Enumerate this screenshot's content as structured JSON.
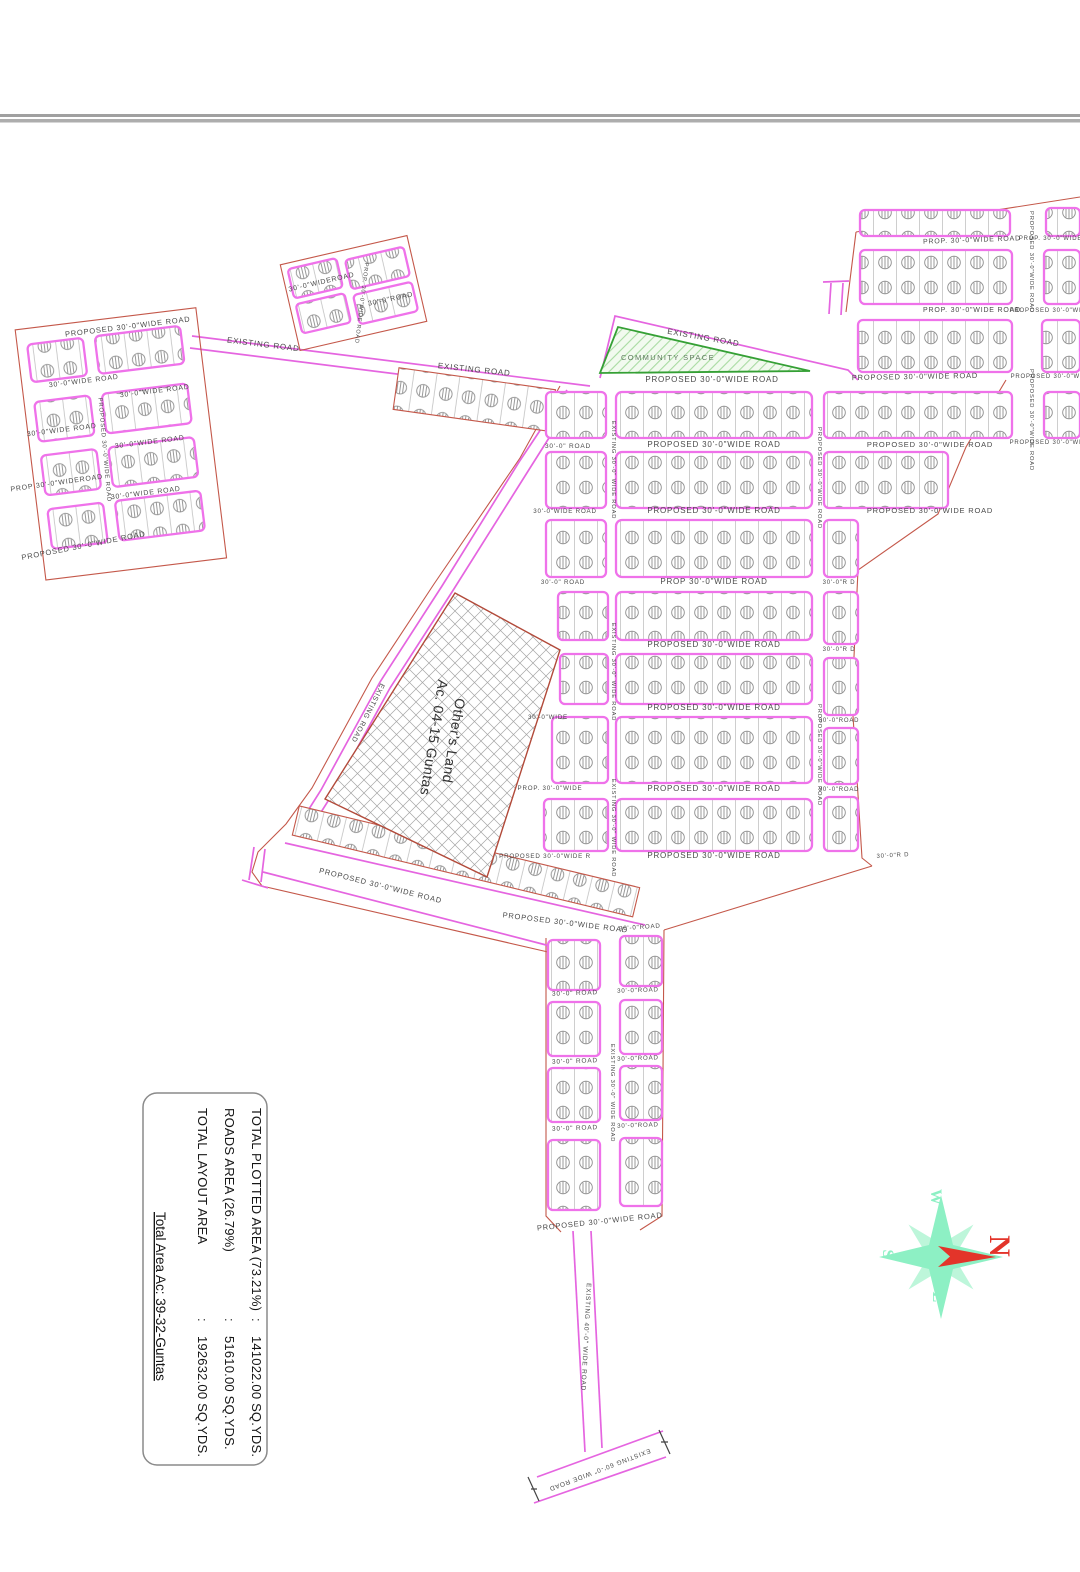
{
  "legend": {
    "rows": [
      {
        "label": "TOTAL PLOTTED AREA (73.21%)",
        "sep": ":",
        "value": "141022.00 SQ.YDS."
      },
      {
        "label": "ROADS AREA  (26.79%)",
        "sep": ":",
        "value": "51610.00  SQ.YDS."
      },
      {
        "label": "TOTAL LAYOUT AREA",
        "sep": ":",
        "value": "192632.00  SQ.YDS."
      }
    ],
    "total": "Total Area Ac: 39-32-Guntas"
  },
  "compass": {
    "n": "N",
    "e": "E",
    "s": "S",
    "w": "W"
  },
  "community_space": {
    "label": "COMMUNITY SPACE"
  },
  "others_land": {
    "line1": "Other's Land",
    "line2": "Ac. 04-15 Guntas"
  },
  "colors": {
    "plot_border": "#ef72ea",
    "road_line": "#e565e0",
    "boundary": "#c4584a",
    "label_text": "#4a4a4a",
    "community_green": "#35a035",
    "compass_green": "#8df0c4",
    "compass_red": "#e3342a"
  },
  "road_labels": [
    {
      "t": "PROPOSED 30'-0\"WIDE ROAD",
      "x": 128,
      "y": 329,
      "r": -7,
      "s": 7.5
    },
    {
      "t": "30'-0\"WIDE ROAD",
      "x": 84,
      "y": 383,
      "r": -7,
      "s": 7
    },
    {
      "t": "30'-0\"WIDE ROAD",
      "x": 155,
      "y": 393,
      "r": -7,
      "s": 7
    },
    {
      "t": "30'-0\"WIDE ROAD",
      "x": 62,
      "y": 432,
      "r": -7,
      "s": 7
    },
    {
      "t": "30'-0\"WIDE ROAD",
      "x": 150,
      "y": 444,
      "r": -7,
      "s": 7
    },
    {
      "t": "PROP 30'-0\"WIDEROAD",
      "x": 57,
      "y": 485,
      "r": -8,
      "s": 7
    },
    {
      "t": "30'-0\"WIDE ROAD",
      "x": 146,
      "y": 495,
      "r": -7,
      "s": 7
    },
    {
      "t": "PROPOSED 30'-0\"WIDE ROAD",
      "x": 84,
      "y": 548,
      "r": -11,
      "s": 7.5
    },
    {
      "t": "PROPOSED 30'-0\"WIDE ROAD",
      "x": 103,
      "y": 450,
      "r": 85,
      "s": 6
    },
    {
      "t": "EXISTING ROAD",
      "x": 263,
      "y": 347,
      "r": 7,
      "s": 8
    },
    {
      "t": "EXISTING ROAD",
      "x": 474,
      "y": 372,
      "r": 6,
      "s": 8
    },
    {
      "t": "EXISTING ROAD",
      "x": 703,
      "y": 340,
      "r": 10,
      "s": 8
    },
    {
      "t": "30'-0\"WIDEROAD",
      "x": 322,
      "y": 284,
      "r": -13,
      "s": 7
    },
    {
      "t": "30'-0\"ROAD",
      "x": 391,
      "y": 301,
      "r": -12,
      "s": 7
    },
    {
      "t": "PROP. 30'-0\"WIDE ROAD",
      "x": 360,
      "y": 303,
      "r": 97,
      "s": 5.6
    },
    {
      "t": "PROPOSED 30'-0\"WIDE ROAD",
      "x": 712,
      "y": 382,
      "r": 0,
      "s": 8
    },
    {
      "t": "PROPOSED 30'-0\"WIDE ROAD",
      "x": 915,
      "y": 379,
      "r": -1,
      "s": 7.5
    },
    {
      "t": "PROPOSED 30'-0\"WIDE ROAD",
      "x": 1063,
      "y": 378,
      "r": 0,
      "s": 6
    },
    {
      "t": "PROPOSED 30'-0\"WIDE ROAD",
      "x": 714,
      "y": 447,
      "r": 0,
      "s": 8
    },
    {
      "t": "PROPOSED 30'-0\"WIDE ROAD",
      "x": 930,
      "y": 447,
      "r": 0,
      "s": 7.5
    },
    {
      "t": "PROPOSED 30'-0\"WIDE ROAD",
      "x": 714,
      "y": 513,
      "r": 0,
      "s": 8
    },
    {
      "t": "PROPOSED 30'-0\"WIDE ROAD",
      "x": 930,
      "y": 513,
      "r": 0,
      "s": 7.5
    },
    {
      "t": "PROP 30'-0\"WIDE ROAD",
      "x": 714,
      "y": 584,
      "r": 0,
      "s": 8
    },
    {
      "t": "PROPOSED 30'-0\"WIDE ROAD",
      "x": 714,
      "y": 647,
      "r": 0,
      "s": 8
    },
    {
      "t": "PROPOSED 30'-0\"WIDE ROAD",
      "x": 714,
      "y": 710,
      "r": 0,
      "s": 8
    },
    {
      "t": "PROPOSED 30'-0\"WIDE ROAD",
      "x": 714,
      "y": 791,
      "r": 0,
      "s": 8
    },
    {
      "t": "PROPOSED 30'-0\"WIDE ROAD",
      "x": 714,
      "y": 858,
      "r": 0,
      "s": 8
    },
    {
      "t": "PROPOSED 30'-0\"WIDE R",
      "x": 545,
      "y": 858,
      "r": 0,
      "s": 6.2
    },
    {
      "t": "30'-0\" ROAD",
      "x": 568,
      "y": 448,
      "r": 0,
      "s": 6.5
    },
    {
      "t": "30'-0\"WIDE ROAD",
      "x": 565,
      "y": 513,
      "r": 0,
      "s": 6.2
    },
    {
      "t": "30'-0\" ROAD",
      "x": 563,
      "y": 584,
      "r": 0,
      "s": 6.2
    },
    {
      "t": "30'-0\"WIDE",
      "x": 548,
      "y": 719,
      "r": 0,
      "s": 6.2
    },
    {
      "t": "PROP. 30'-0\"WIDE",
      "x": 550,
      "y": 790,
      "r": 0,
      "s": 6.2
    },
    {
      "t": "EXISTING 30'-0\" WIDE ROAD",
      "x": 612,
      "y": 470,
      "r": 90,
      "s": 5.8
    },
    {
      "t": "EXISTING 30'-0\" WIDE ROAD",
      "x": 612,
      "y": 672,
      "r": 90,
      "s": 5.8
    },
    {
      "t": "EXISTING 30'-0\" WIDE ROAD",
      "x": 612,
      "y": 828,
      "r": 90,
      "s": 5.8
    },
    {
      "t": "PROPOSED 30'-0\"WIDE ROAD",
      "x": 818,
      "y": 478,
      "r": 90,
      "s": 5.8
    },
    {
      "t": "PROPOSED 30'-0\"WIDE ROAD",
      "x": 818,
      "y": 755,
      "r": 90,
      "s": 5.8
    },
    {
      "t": "30'-0\"R D",
      "x": 839,
      "y": 584,
      "r": 0,
      "s": 6
    },
    {
      "t": "30'-0\"R D",
      "x": 839,
      "y": 651,
      "r": 0,
      "s": 6
    },
    {
      "t": "30'-0\"ROAD",
      "x": 839,
      "y": 722,
      "r": 0,
      "s": 6
    },
    {
      "t": "30'-0\"ROAD",
      "x": 839,
      "y": 791,
      "r": 0,
      "s": 6
    },
    {
      "t": "30'-0\"R D",
      "x": 893,
      "y": 857,
      "r": -3,
      "s": 6
    },
    {
      "t": "PROP. 30'-0\"WIDE ROAD",
      "x": 972,
      "y": 242,
      "r": -2,
      "s": 7
    },
    {
      "t": "PROP. 30'-0\"WIDE ROAD",
      "x": 1062,
      "y": 240,
      "r": 0,
      "s": 6
    },
    {
      "t": "PROP. 30'-0\"WIDE ROAD",
      "x": 972,
      "y": 312,
      "r": 0,
      "s": 7
    },
    {
      "t": "PROPOSED 30'-0\"WIDE ROAD",
      "x": 1062,
      "y": 312,
      "r": 0,
      "s": 6
    },
    {
      "t": "PROPOSED 30'-0\"WIDE ROAD",
      "x": 1062,
      "y": 444,
      "r": 0,
      "s": 6
    },
    {
      "t": "PROPOSED 30'-0\"WIDE ROAD",
      "x": 1030,
      "y": 262,
      "r": 90,
      "s": 5.8
    },
    {
      "t": "PROPOSED 30'-0\"WIDE ROAD",
      "x": 1030,
      "y": 420,
      "r": 90,
      "s": 5.8
    },
    {
      "t": "EXISTING ROAD",
      "x": 366,
      "y": 712,
      "r": 117,
      "s": 7
    },
    {
      "t": "PROPOSED 30'-0\"WIDE ROAD",
      "x": 380,
      "y": 888,
      "r": 14,
      "s": 7.5
    },
    {
      "t": "PROPOSED 30'-0\"WIDE ROAD",
      "x": 565,
      "y": 925,
      "r": 7,
      "s": 7.5
    },
    {
      "t": "30'-0\"ROAD",
      "x": 640,
      "y": 929,
      "r": -4,
      "s": 6.2
    },
    {
      "t": "30'-0\" ROAD",
      "x": 575,
      "y": 995,
      "r": -2,
      "s": 6.5
    },
    {
      "t": "30'-0\"ROAD",
      "x": 638,
      "y": 992,
      "r": -2,
      "s": 6.2
    },
    {
      "t": "30'-0\" ROAD",
      "x": 575,
      "y": 1063,
      "r": -2,
      "s": 6.5
    },
    {
      "t": "30'-0\"ROAD",
      "x": 638,
      "y": 1060,
      "r": -2,
      "s": 6.2
    },
    {
      "t": "30'-0\" ROAD",
      "x": 575,
      "y": 1130,
      "r": -2,
      "s": 6.5
    },
    {
      "t": "30'-0\"ROAD",
      "x": 638,
      "y": 1127,
      "r": -2,
      "s": 6.2
    },
    {
      "t": "EXISTING 30'-0\" WIDE ROAD",
      "x": 611,
      "y": 1093,
      "r": 90,
      "s": 5.8
    },
    {
      "t": "PROPOSED 30'-0\"WIDE ROAD",
      "x": 600,
      "y": 1224,
      "r": -6,
      "s": 7.5
    },
    {
      "t": "EXISTING 40'-0\" WIDE ROAD",
      "x": 584,
      "y": 1337,
      "r": 93,
      "s": 6.5
    },
    {
      "t": "EXISTING 60'-0\" WIDE ROAD",
      "x": 599,
      "y": 1468,
      "r": 159,
      "s": 6.5
    }
  ]
}
